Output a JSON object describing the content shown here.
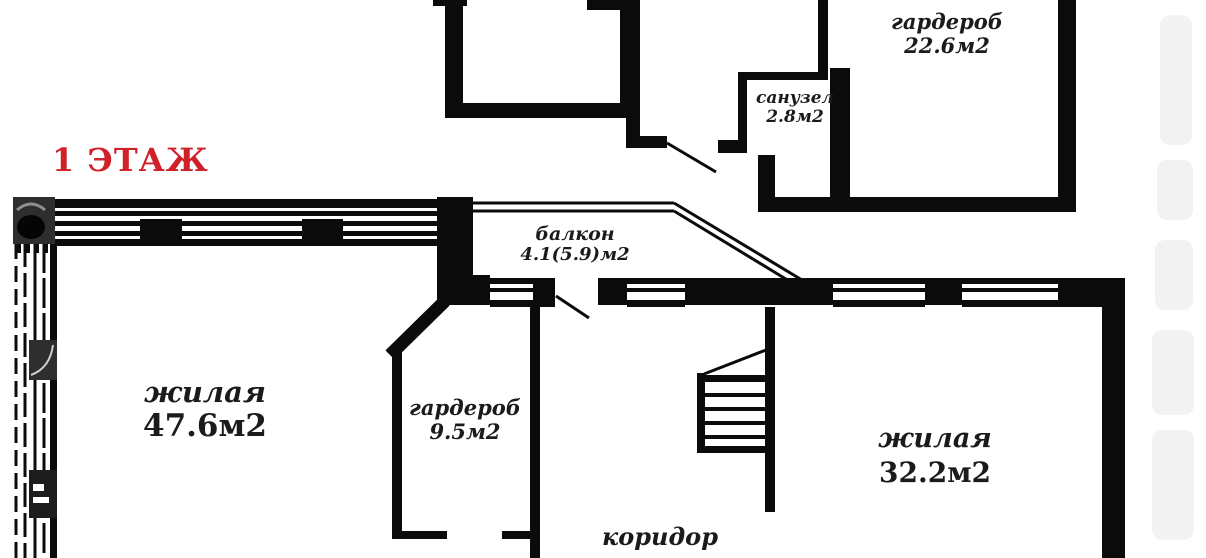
{
  "title": {
    "text": "1 ЭТАЖ",
    "color": "#cf2127"
  },
  "colors": {
    "walls": "#0b0b0b",
    "background": "#ffffff",
    "label_text": "#1b1b1b"
  },
  "rooms": [
    {
      "id": "wardrobe-top",
      "name": "гардероб",
      "area": "22.6м2"
    },
    {
      "id": "bathroom",
      "name": "санузел",
      "area": "2.8м2"
    },
    {
      "id": "balcony",
      "name": "балкон",
      "area": "4.1(5.9)м2"
    },
    {
      "id": "living-left",
      "name": "жилая",
      "area": "47.6м2"
    },
    {
      "id": "wardrobe-small",
      "name": "гардероб",
      "area": "9.5м2"
    },
    {
      "id": "living-right",
      "name": "жилая",
      "area": "32.2м2"
    },
    {
      "id": "corridor",
      "name": "коридор",
      "area": ""
    }
  ]
}
